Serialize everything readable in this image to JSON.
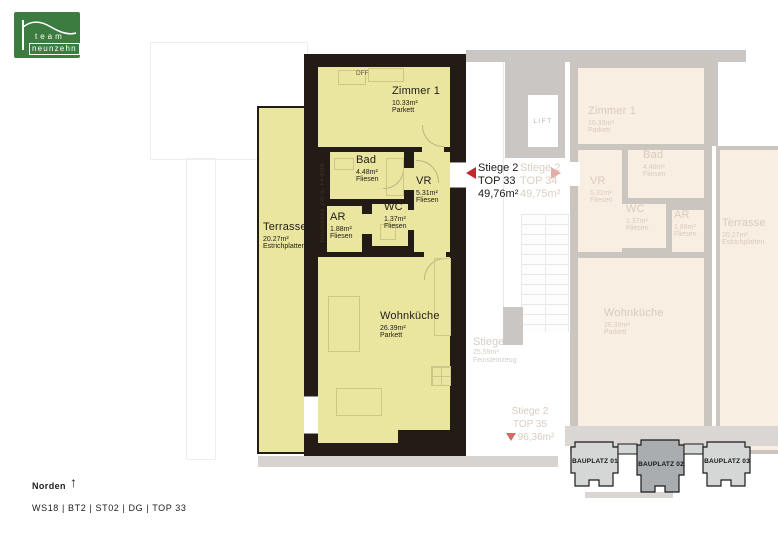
{
  "logo": {
    "line1": "team",
    "line2": "neunzehn"
  },
  "main_unit": {
    "tag": {
      "stiege": "Stiege 2",
      "top": "TOP 33",
      "area": "49,76m²"
    },
    "rooms": {
      "zimmer1": {
        "name": "Zimmer 1",
        "area": "10.33m²",
        "floor": "Parkett"
      },
      "bad": {
        "name": "Bad",
        "area": "4.48m²",
        "floor": "Fliesen"
      },
      "vr": {
        "name": "VR",
        "area": "5.31m²",
        "floor": "Fliesen"
      },
      "ar": {
        "name": "AR",
        "area": "1.88m²",
        "floor": "Fliesen"
      },
      "wc": {
        "name": "WC",
        "area": "1.37m²",
        "floor": "Fliesen"
      },
      "wohnkueche": {
        "name": "Wohnküche",
        "area": "26.39m²",
        "floor": "Parkett"
      },
      "terrasse": {
        "name": "Terrasse",
        "area": "20.27m²",
        "floor": "Estrichplatten"
      }
    },
    "annotations": {
      "dff": "DFF",
      "wall_note": "Raumhöhe 2m ü. FFBOK"
    }
  },
  "neighbor_unit": {
    "tag": {
      "stiege": "Stiege 2",
      "top": "TOP 34",
      "area": "49,75m²"
    },
    "rooms": {
      "zimmer1": {
        "name": "Zimmer 1",
        "area": "10.33m²",
        "floor": "Parkett"
      },
      "bad": {
        "name": "Bad",
        "area": "4.48m²",
        "floor": "Fliesen"
      },
      "vr": {
        "name": "VR",
        "area": "5.31m²",
        "floor": "Fliesen"
      },
      "ar": {
        "name": "AR",
        "area": "1.88m²",
        "floor": "Fliesen"
      },
      "wc": {
        "name": "WC",
        "area": "1.37m²",
        "floor": "Fliesen"
      },
      "wohnkueche": {
        "name": "Wohnküche",
        "area": "26.39m²",
        "floor": "Parkett"
      },
      "terrasse": {
        "name": "Terrasse",
        "area": "20.27m²",
        "floor": "Estrichplatten"
      }
    }
  },
  "stairwell": {
    "lift": "LIFT",
    "stiege": {
      "name": "Stiege",
      "area": "25,59m²",
      "floor": "Feinsteinzeug"
    },
    "top35": {
      "stiege": "Stiege 2",
      "top": "TOP 35",
      "area": "96,36m²"
    }
  },
  "bauplaetze": [
    {
      "label": "BAUPLATZ 01"
    },
    {
      "label": "BAUPLATZ 02"
    },
    {
      "label": "BAUPLATZ 03"
    }
  ],
  "footer": {
    "north_label": "Norden",
    "project_code": "WS18 | BT2 | ST02 | DG | TOP 33"
  },
  "colors": {
    "accent_red": "#c4262c",
    "room_yellow": "#eae59f",
    "wall_black": "#231b15",
    "logo_green": "#3d7c41",
    "faded_room_cream": "#f8efe2",
    "faded_wall_gray": "#cbc5c0",
    "bauplatz_selected_gray": "#a9adb0",
    "bauplatz_gray": "#d5d6d6"
  }
}
